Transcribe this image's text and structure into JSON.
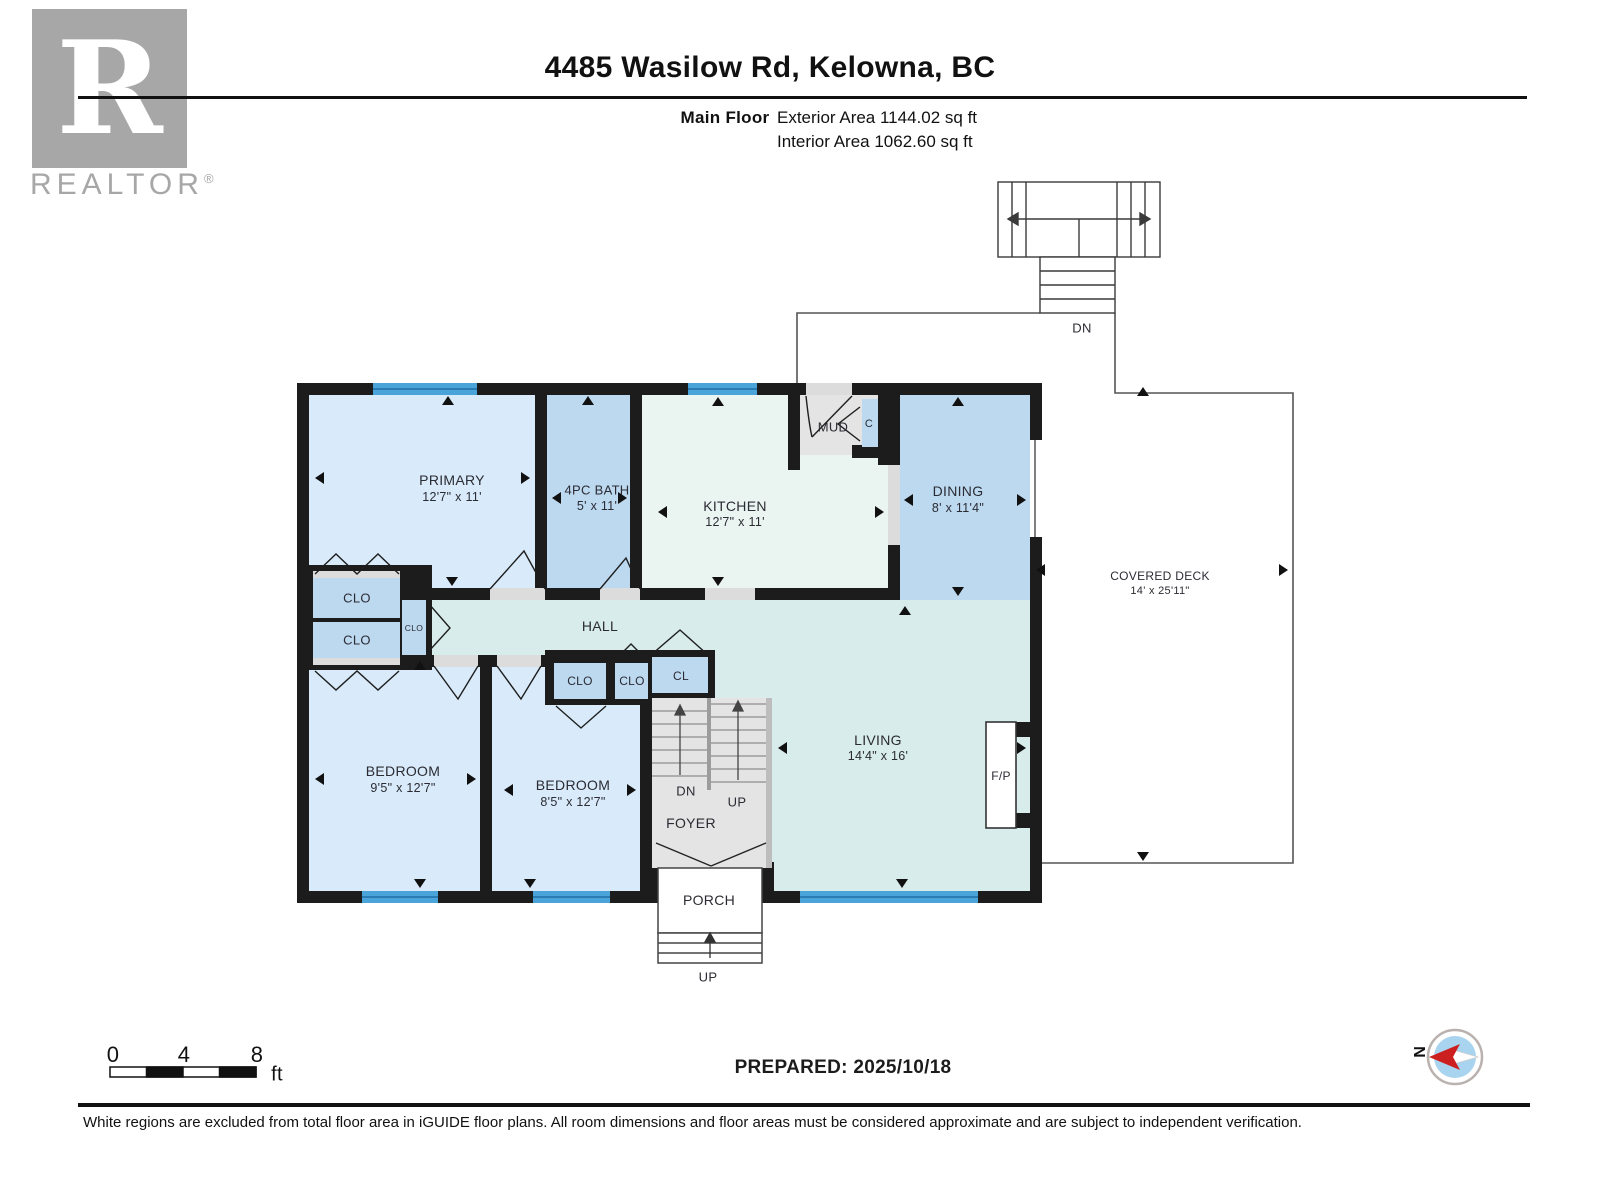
{
  "header": {
    "logo_letter": "R",
    "brand": "REALTOR",
    "brand_reg": "®",
    "title": "4485 Wasilow Rd, Kelowna, BC",
    "floor_label": "Main Floor",
    "exterior_area": "Exterior Area 1144.02 sq ft",
    "interior_area": "Interior Area 1062.60 sq ft"
  },
  "rooms": {
    "primary": {
      "name": "PRIMARY",
      "dims": "12'7\" x 11'"
    },
    "bath": {
      "name": "4PC BATH",
      "dims": "5' x 11'"
    },
    "kitchen": {
      "name": "KITCHEN",
      "dims": "12'7\" x 11'"
    },
    "mud": {
      "name": "MUD"
    },
    "dining": {
      "name": "DINING",
      "dims": "8' x 11'4\""
    },
    "hall": {
      "name": "HALL"
    },
    "bedroom1": {
      "name": "BEDROOM",
      "dims": "9'5\" x 12'7\""
    },
    "bedroom2": {
      "name": "BEDROOM",
      "dims": "8'5\" x 12'7\""
    },
    "living": {
      "name": "LIVING",
      "dims": "14'4\" x 16'"
    },
    "foyer": {
      "name": "FOYER"
    },
    "porch": {
      "name": "PORCH"
    },
    "deck": {
      "name": "COVERED DECK",
      "dims": "14' x 25'11\""
    },
    "fireplace": {
      "name": "F/P"
    }
  },
  "closets": {
    "clo": "CLO",
    "cl": "CL",
    "c": "C"
  },
  "stairs": {
    "dn": "DN",
    "up": "UP"
  },
  "deck_stairs": {
    "dn": "DN"
  },
  "porch_steps": {
    "up": "UP"
  },
  "scale_bar": {
    "t0": "0",
    "t4": "4",
    "t8": "8",
    "unit": "ft"
  },
  "compass": {
    "north": "N"
  },
  "footer": {
    "prepared": "PREPARED: 2025/10/18",
    "disclaimer": "White regions are excluded from total floor area in iGUIDE floor plans. All room dimensions and floor areas must be considered approximate and are subject to independent verification."
  },
  "colors": {
    "wall": "#1c1c1c",
    "room_light": "#d9ebfa",
    "room_medium": "#bdd9f0",
    "kitchen_fill": "#eaf4f1",
    "hall_fill": "#d8eceb",
    "gray_fill": "#e4e4e4",
    "sill": "#dcdcdc",
    "window_blue": "#4aa4da",
    "window_dark": "#1f6fa6",
    "deck_line": "#555555",
    "label_color": "#2b2b33",
    "logo_gray": "#a7a7a7",
    "compass_blue": "#a8d4f0",
    "compass_red": "#cc2020"
  }
}
